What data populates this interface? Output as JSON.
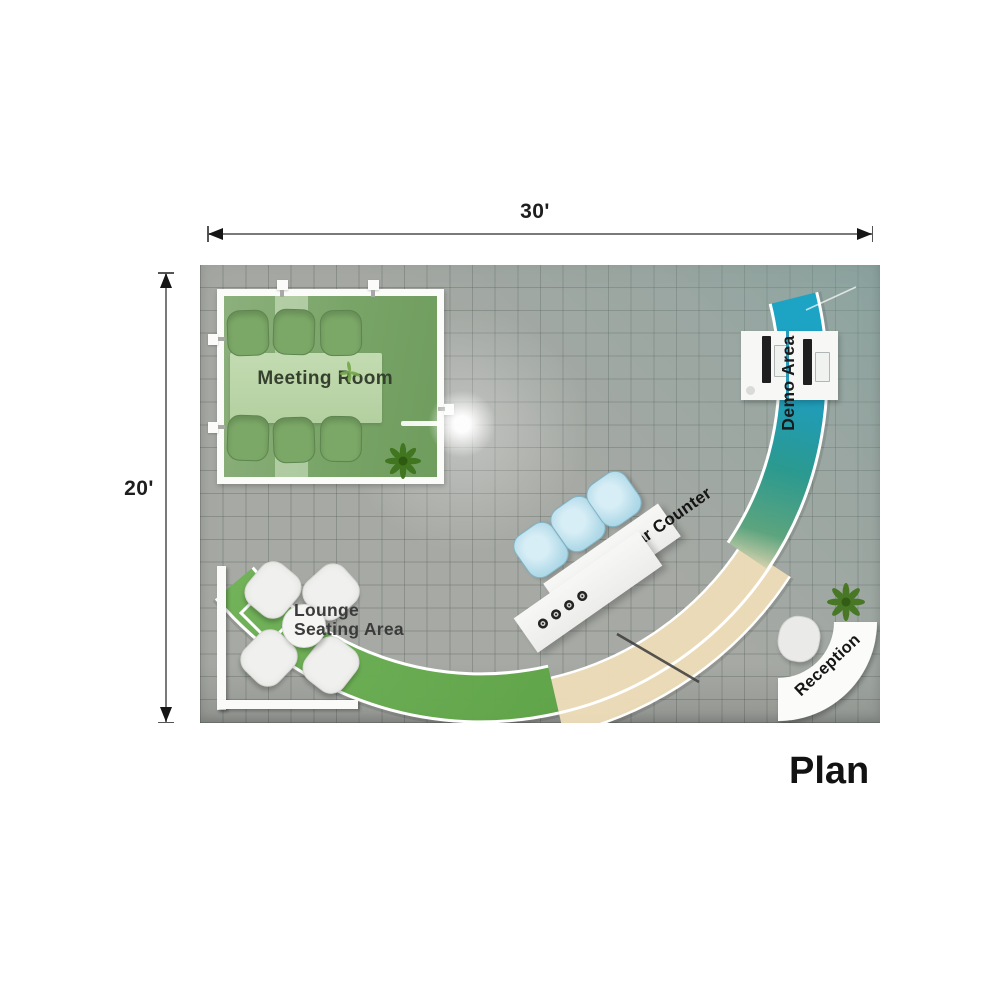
{
  "title_label": "Plan",
  "dimensions": {
    "width": "30'",
    "height": "20'"
  },
  "rooms": {
    "meeting_room": "Meeting Room",
    "demo_area": "Demo Area",
    "bar_counter": "Bar Counter",
    "lounge_line1": "Lounge",
    "lounge_line2": "Seating Area",
    "reception": "Reception"
  },
  "colors": {
    "floor_gray": "#a6a9a4",
    "demo_tint": "#76a09c",
    "band_green": "#66a94e",
    "band_beige": "#ecdcb8",
    "band_teal": "#2a9c85",
    "band_blue": "#18a0c4",
    "meeting_green": "#7ca86c",
    "stool_blue": "#b5dcea",
    "wall_white": "#fbfbfa"
  }
}
